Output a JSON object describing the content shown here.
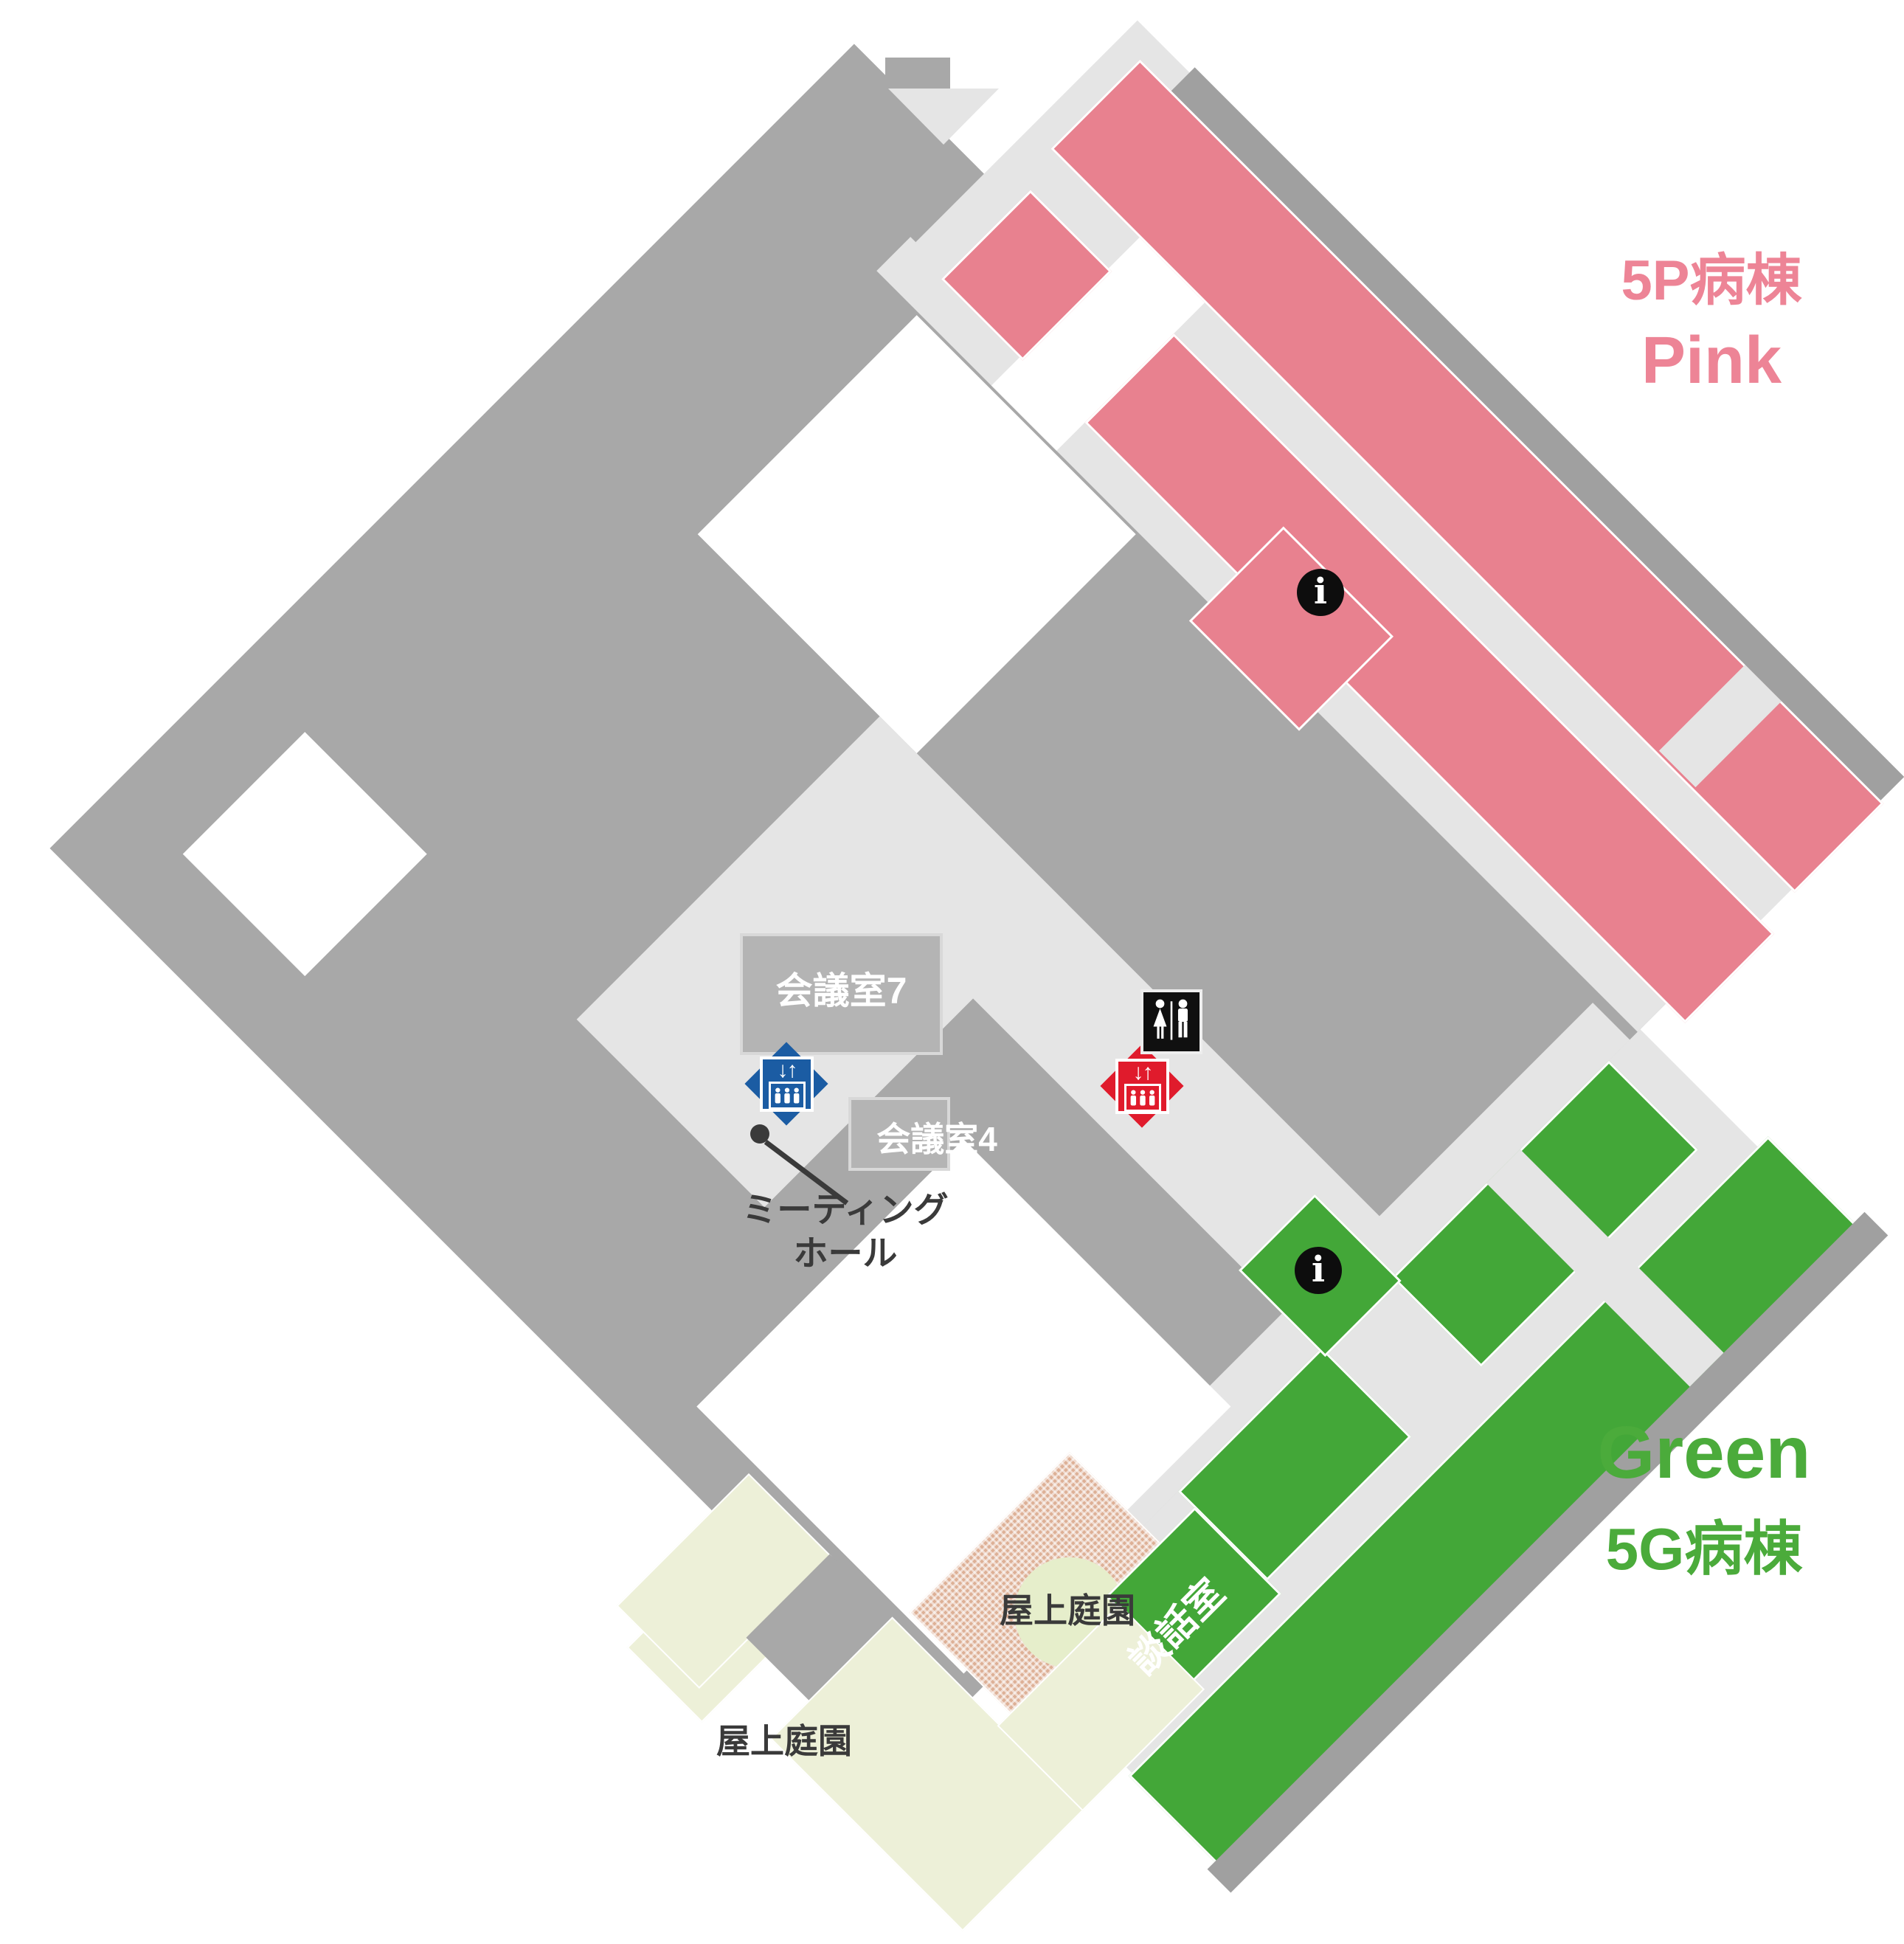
{
  "wards": {
    "pink": {
      "kanji": "5P病棟",
      "en": "Pink",
      "color": "#E8818F"
    },
    "green": {
      "en": "Green",
      "kanji": "5G病棟",
      "color": "#43A738"
    }
  },
  "rooms": {
    "conference7": "会議室7",
    "conference4": "会議室4",
    "meeting_hall_line1": "ミーティング",
    "meeting_hall_line2": "ホール",
    "lounge": "談話室",
    "rooftop_garden_upper": "屋上庭園",
    "rooftop_garden_lower": "屋上庭園"
  },
  "icons": {
    "elevator_arrows": "↓↑",
    "info": "i",
    "elevator_blue": "elevator",
    "elevator_red": "elevator",
    "toilet": "toilet"
  },
  "colors": {
    "base_gray": "#A8A8A8",
    "corridor": "#E5E5E5",
    "pink_ward": "#E8818F",
    "green_ward": "#43A738",
    "cream_garden": "#EDF0D8",
    "garden_hatch": "#DDB096",
    "garden_circle": "#E6EECB",
    "blue_elevator": "#1B5CA3",
    "red_elevator": "#E01B2C",
    "icon_black": "#101010"
  }
}
